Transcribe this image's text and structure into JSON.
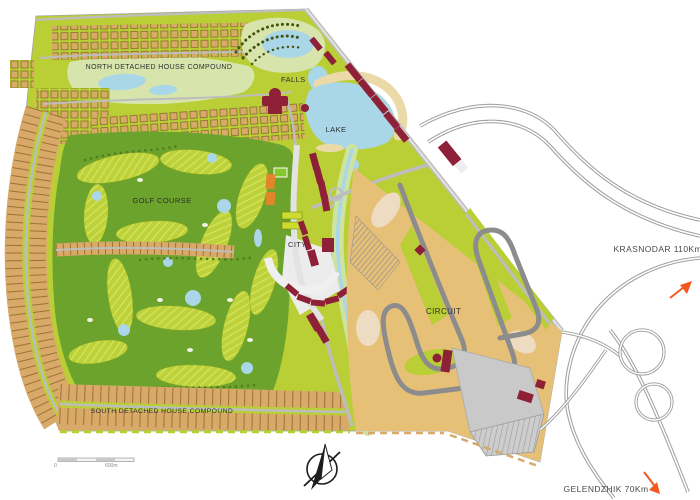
{
  "map": {
    "title": "Resort development master plan",
    "regions": {
      "north_compound": "NORTH DETACHED HOUSE COMPOUND",
      "falls": "FALLS",
      "lake": "LAKE",
      "golf_course": "GOLF COURSE",
      "city": "CITY",
      "circuit": "CIRCUIT",
      "south_compound": "SOUTH DETACHED HOUSE COMPOUND"
    },
    "directions": {
      "krasnodar": "KRASNODAR 110Km",
      "gelendzhik": "GELENDZHIK 70Km"
    },
    "scale_bar": {
      "zero": "0",
      "end": "600m"
    },
    "icons": [
      "compass-rose-icon",
      "krasnodar-arrow-icon",
      "gelendzhik-arrow-icon"
    ],
    "colors": {
      "lime": "#b9cf35",
      "golf": "#6ba32c",
      "water": "#a9d7e8",
      "sand": "#e7c077",
      "tan": "#d8a968",
      "tick": "#9a7434",
      "maroon": "#8e2038",
      "orange": "#e3862b",
      "road": "#bdbdbd",
      "park": "#d7e5ad",
      "beach": "#ecd9a8",
      "slab": "#c9c9c9",
      "bank": "#cfe3a0",
      "track": "#8c8c8c",
      "highway": "#9e9e9e",
      "text": "#2e2e2e",
      "arrow": "#f2571f"
    }
  }
}
